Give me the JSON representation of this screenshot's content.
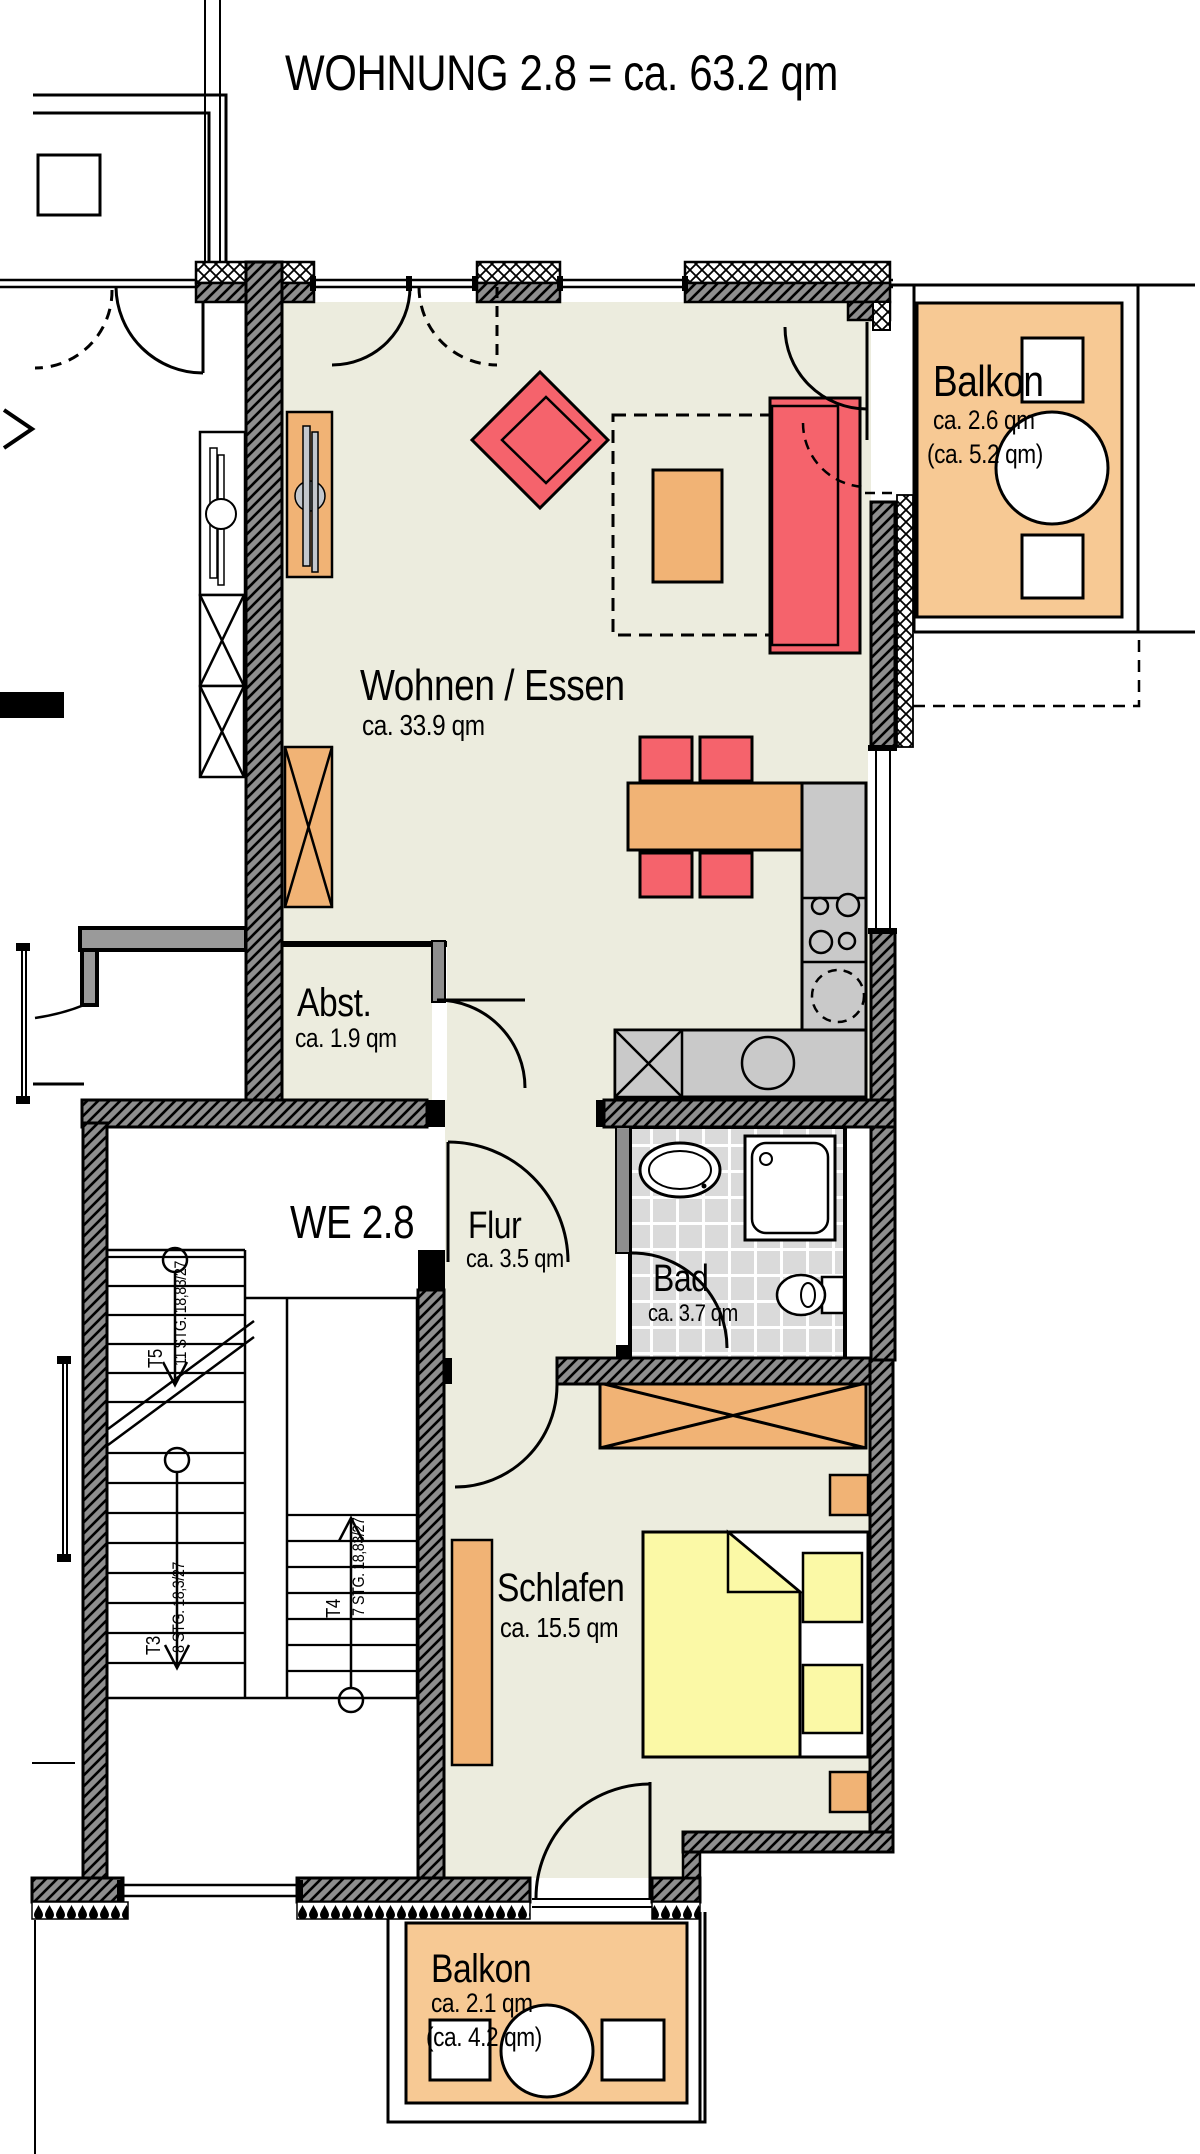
{
  "title": "WOHNUNG 2.8 = ca. 63.2 qm",
  "unit_label": "WE 2.8",
  "rooms": {
    "wohnen": {
      "name": "Wohnen / Essen",
      "area": "ca. 33.9 qm"
    },
    "abst": {
      "name": "Abst.",
      "area": "ca. 1.9 qm"
    },
    "flur": {
      "name": "Flur",
      "area": "ca. 3.5 qm"
    },
    "bad": {
      "name": "Bad",
      "area": "ca. 3.7 qm"
    },
    "schlafen": {
      "name": "Schlafen",
      "area": "ca. 15.5 qm"
    },
    "balkon_top": {
      "name": "Balkon",
      "area": "ca. 2.6 qm",
      "area_total": "(ca. 5.2 qm)"
    },
    "balkon_bottom": {
      "name": "Balkon",
      "area": "ca. 2.1 qm",
      "area_total": "(ca. 4.2 qm)"
    }
  },
  "stairs": {
    "t5": {
      "id": "T5",
      "steps": "11 STG. 18,83/27"
    },
    "t3": {
      "id": "T3",
      "steps": "8 STG. 18,3/27"
    },
    "t4": {
      "id": "T4",
      "steps": "7 STG. 18,83/27"
    }
  },
  "colors": {
    "room_floor": "#ECECDE",
    "balcony": "#F7C994",
    "furniture_wood": "#F1B375",
    "upholstery_red": "#F5636C",
    "bed_yellow": "#FBF9A6",
    "counter_gray": "#C9C9C9",
    "wall_gray": "#8E8E8E",
    "tile_gray": "#DADADA",
    "line": "#000000"
  }
}
